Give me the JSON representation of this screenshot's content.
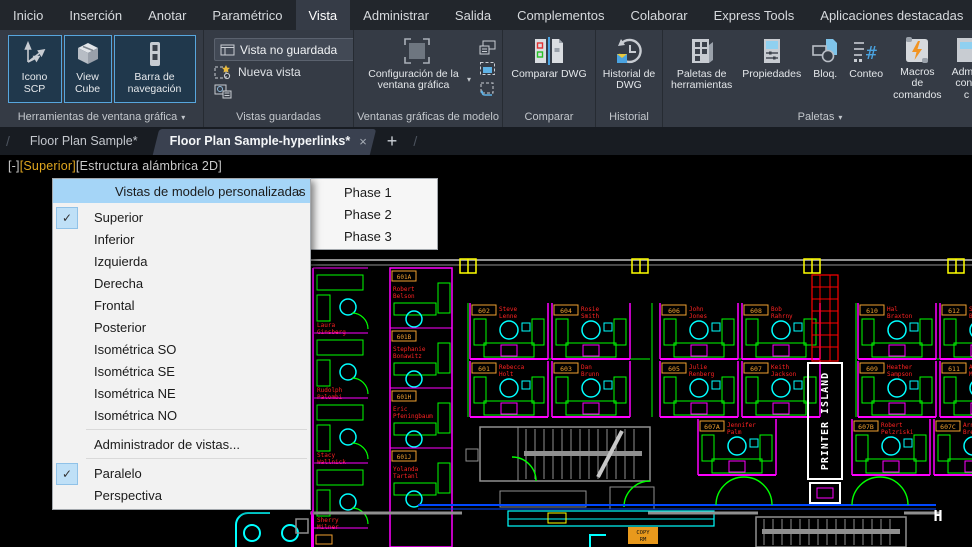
{
  "ribbon": {
    "active_tab": "Vista",
    "collapse_caret": "▴",
    "tabs": [
      {
        "label": "Inicio"
      },
      {
        "label": "Inserción"
      },
      {
        "label": "Anotar"
      },
      {
        "label": "Paramétrico"
      },
      {
        "label": "Vista"
      },
      {
        "label": "Administrar"
      },
      {
        "label": "Salida"
      },
      {
        "label": "Complementos"
      },
      {
        "label": "Colaborar"
      },
      {
        "label": "Express Tools"
      },
      {
        "label": "Aplicaciones destacadas"
      }
    ],
    "viewport_tools": {
      "caption": "Herramientas de ventana gráfica",
      "buttons": [
        {
          "label": "Icono SCP"
        },
        {
          "label": "View Cube"
        },
        {
          "label": "Barra de navegación"
        }
      ]
    },
    "named_views": {
      "caption": "Vistas guardadas",
      "combo_value": "Vista no guardada",
      "new_view_label": "Nueva vista"
    },
    "model_viewports": {
      "caption": "Ventanas gráficas de modelo",
      "main_label": "Configuración de la ventana gráfica"
    },
    "compare": {
      "caption": "Comparar",
      "button_label": "Comparar DWG"
    },
    "history": {
      "caption": "Historial",
      "button_label": "Historial de DWG"
    },
    "palettes": {
      "caption": "Paletas",
      "buttons": [
        {
          "label": "Paletas de herramientas"
        },
        {
          "label": "Propiedades"
        },
        {
          "label": "Bloq."
        },
        {
          "label": "Conteo"
        },
        {
          "label": "Macros de comandos"
        },
        {
          "label": "Admin conj. c"
        }
      ]
    }
  },
  "file_tabs": {
    "tabs": [
      {
        "label": "Floor Plan Sample*",
        "active": false
      },
      {
        "label": "Floor Plan Sample-hyperlinks*",
        "active": true
      }
    ],
    "add_label": "+",
    "close_label": "×"
  },
  "viewport_controls": {
    "minimize": "[-]",
    "view_name": "[Superior]",
    "visual_style": "[Estructura alámbrica 2D]"
  },
  "context_menu": {
    "header": {
      "label": "Vistas de modelo personalizadas",
      "arrow": "›"
    },
    "items": [
      {
        "label": "Superior",
        "checked": true
      },
      {
        "label": "Inferior"
      },
      {
        "label": "Izquierda"
      },
      {
        "label": "Derecha"
      },
      {
        "label": "Frontal"
      },
      {
        "label": "Posterior"
      },
      {
        "label": "Isométrica SO"
      },
      {
        "label": "Isométrica SE"
      },
      {
        "label": "Isométrica NE"
      },
      {
        "label": "Isométrica NO"
      },
      {
        "label": "Administrador de vistas...",
        "sep_before": true
      },
      {
        "label": "Paralelo",
        "checked": true,
        "sep_before": true
      },
      {
        "label": "Perspectiva"
      }
    ],
    "submenu": {
      "items": [
        {
          "label": "Phase 1"
        },
        {
          "label": "Phase 2"
        },
        {
          "label": "Phase 3"
        }
      ]
    }
  },
  "drawing": {
    "palette": {
      "wall": "#ff00ff",
      "furniture": "#00ff00",
      "chair": "#00ffff",
      "name": "#ff2222",
      "tag": "#f0a030",
      "column": "#ffff00",
      "structure": "#909090",
      "accent": "#0048ff",
      "white": "#ffffff",
      "shaft": "#ff0000"
    },
    "printer_island_label": "PRINTER ISLAND",
    "copy_room_label": "COPY RM",
    "h_column_label": "H",
    "rooms": [
      {
        "name": "Laura Ginsberg"
      },
      {
        "name": "Rudolph Palombi"
      },
      {
        "name": "Stacy Wallnick"
      },
      {
        "name": "Sherry Milner"
      }
    ],
    "offices": [
      {
        "tag": "601A",
        "name": "Robert Belson"
      },
      {
        "tag": "601B",
        "name": "Stephanie Bonawitz"
      },
      {
        "tag": "601H",
        "name": "Eric Pfeningbaum"
      },
      {
        "tag": "601J",
        "name": "Yolanda Tartanl"
      }
    ],
    "pods": [
      {
        "x": 470,
        "y": 148,
        "tag": "602",
        "name": "Steve Lenne"
      },
      {
        "x": 552,
        "y": 148,
        "tag": "604",
        "name": "Rosie Smith"
      },
      {
        "x": 660,
        "y": 148,
        "tag": "606",
        "name": "John Jones"
      },
      {
        "x": 742,
        "y": 148,
        "tag": "608",
        "name": "Bob Rahrny"
      },
      {
        "x": 858,
        "y": 148,
        "tag": "610",
        "name": "Hal Braxton"
      },
      {
        "x": 940,
        "y": 148,
        "tag": "612",
        "name": "Susan Brehe"
      },
      {
        "x": 470,
        "y": 206,
        "tag": "601",
        "name": "Rebecca Holt"
      },
      {
        "x": 552,
        "y": 206,
        "tag": "603",
        "name": "Dan Brunn"
      },
      {
        "x": 660,
        "y": 206,
        "tag": "605",
        "name": "Julie Renberg"
      },
      {
        "x": 742,
        "y": 206,
        "tag": "607",
        "name": "Keith Jackson"
      },
      {
        "x": 858,
        "y": 206,
        "tag": "609",
        "name": "Heather Sampson"
      },
      {
        "x": 940,
        "y": 206,
        "tag": "611",
        "name": "Art Muwwwld"
      },
      {
        "x": 698,
        "y": 264,
        "tag": "607A",
        "name": "Jennifer Palm"
      },
      {
        "x": 852,
        "y": 264,
        "tag": "607B",
        "name": "Robert Pelzriski"
      },
      {
        "x": 934,
        "y": 264,
        "tag": "607C",
        "name": "Arnold Breen"
      }
    ]
  }
}
